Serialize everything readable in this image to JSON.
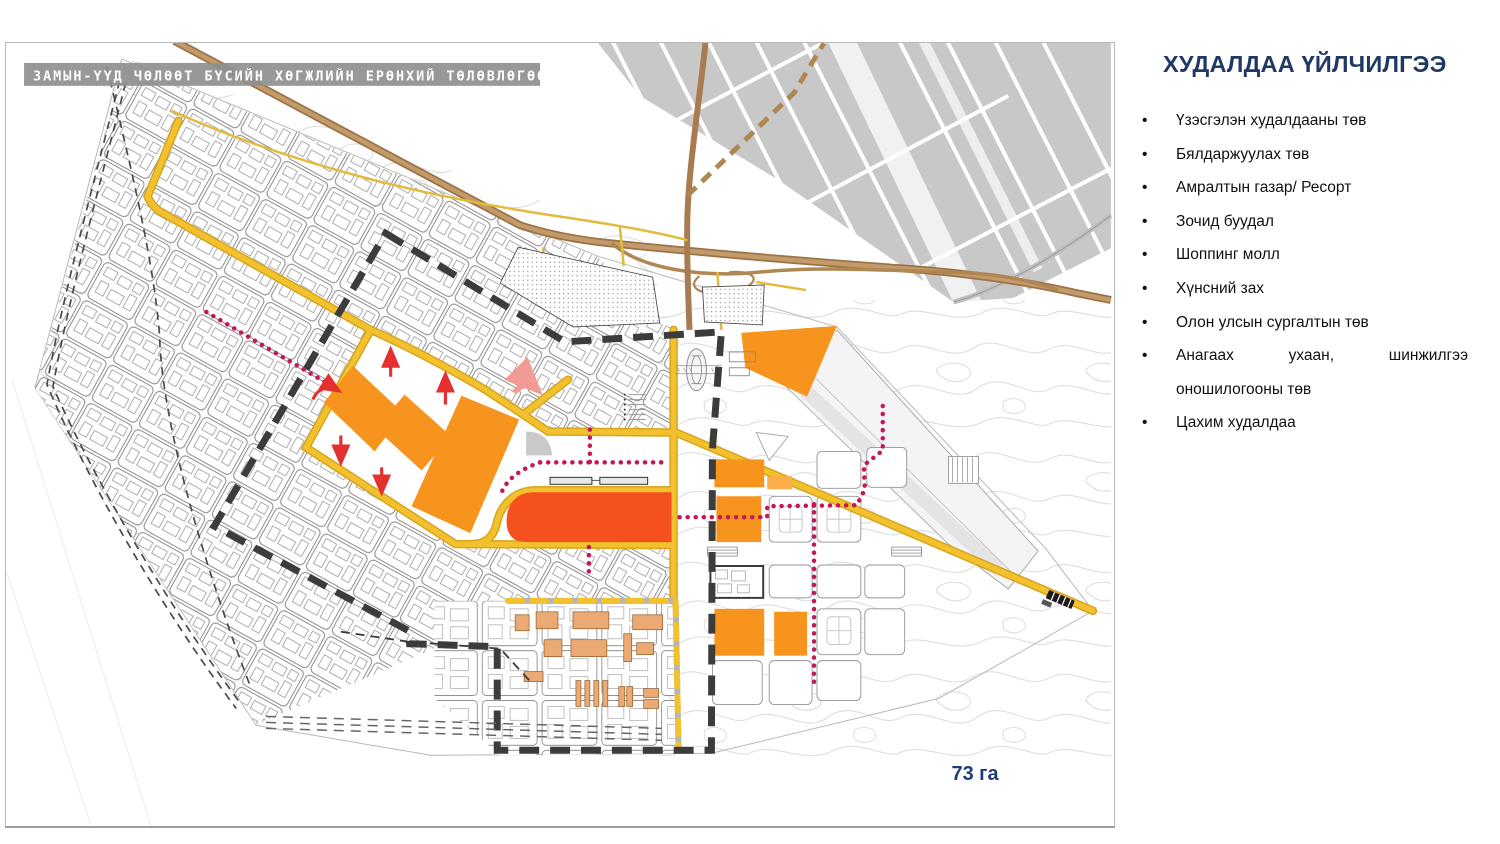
{
  "map": {
    "banner_title": "ЗАМЫН-ҮҮД ЧӨЛӨӨТ БҮСИЙН ХӨГЖЛИЙН ЕРӨНХИЙ ТӨЛӨВЛӨГӨӨ",
    "area_label": "73 га",
    "colors": {
      "parcel_orange": "#F7941E",
      "parcel_orange_light": "#FBAE4A",
      "parcel_highlight": "#F4511E",
      "road_yellow": "#F2C12E",
      "road_brown": "#A87C50",
      "boundary_dark": "#3C3C3C",
      "path_red": "#C2185B",
      "arrow_red": "#E53030",
      "built_gray": "#C8C8C8",
      "building_tan": "#EBAA73",
      "banner_gray": "#8F8F8F",
      "area_label_blue": "#1E3C78"
    }
  },
  "panel": {
    "title": "ХУДАЛДАА ҮЙЛЧИЛГЭЭ",
    "title_color": "#1F3864",
    "items": [
      {
        "line1": "Үзэсгэлэн худалдааны төв"
      },
      {
        "line1": "Бялдаржуулах төв"
      },
      {
        "line1": "Амралтын газар/ Ресорт"
      },
      {
        "line1": "Зочид буудал"
      },
      {
        "line1": "Шоппинг молл"
      },
      {
        "line1": "Хүнсний зах"
      },
      {
        "line1": "Олон улсын сургалтын төв"
      },
      {
        "line1": "Анагаах ухаан, шинжилгээ",
        "line2": "оношилогооны төв"
      },
      {
        "line1": "Цахим худалдаа"
      }
    ]
  }
}
